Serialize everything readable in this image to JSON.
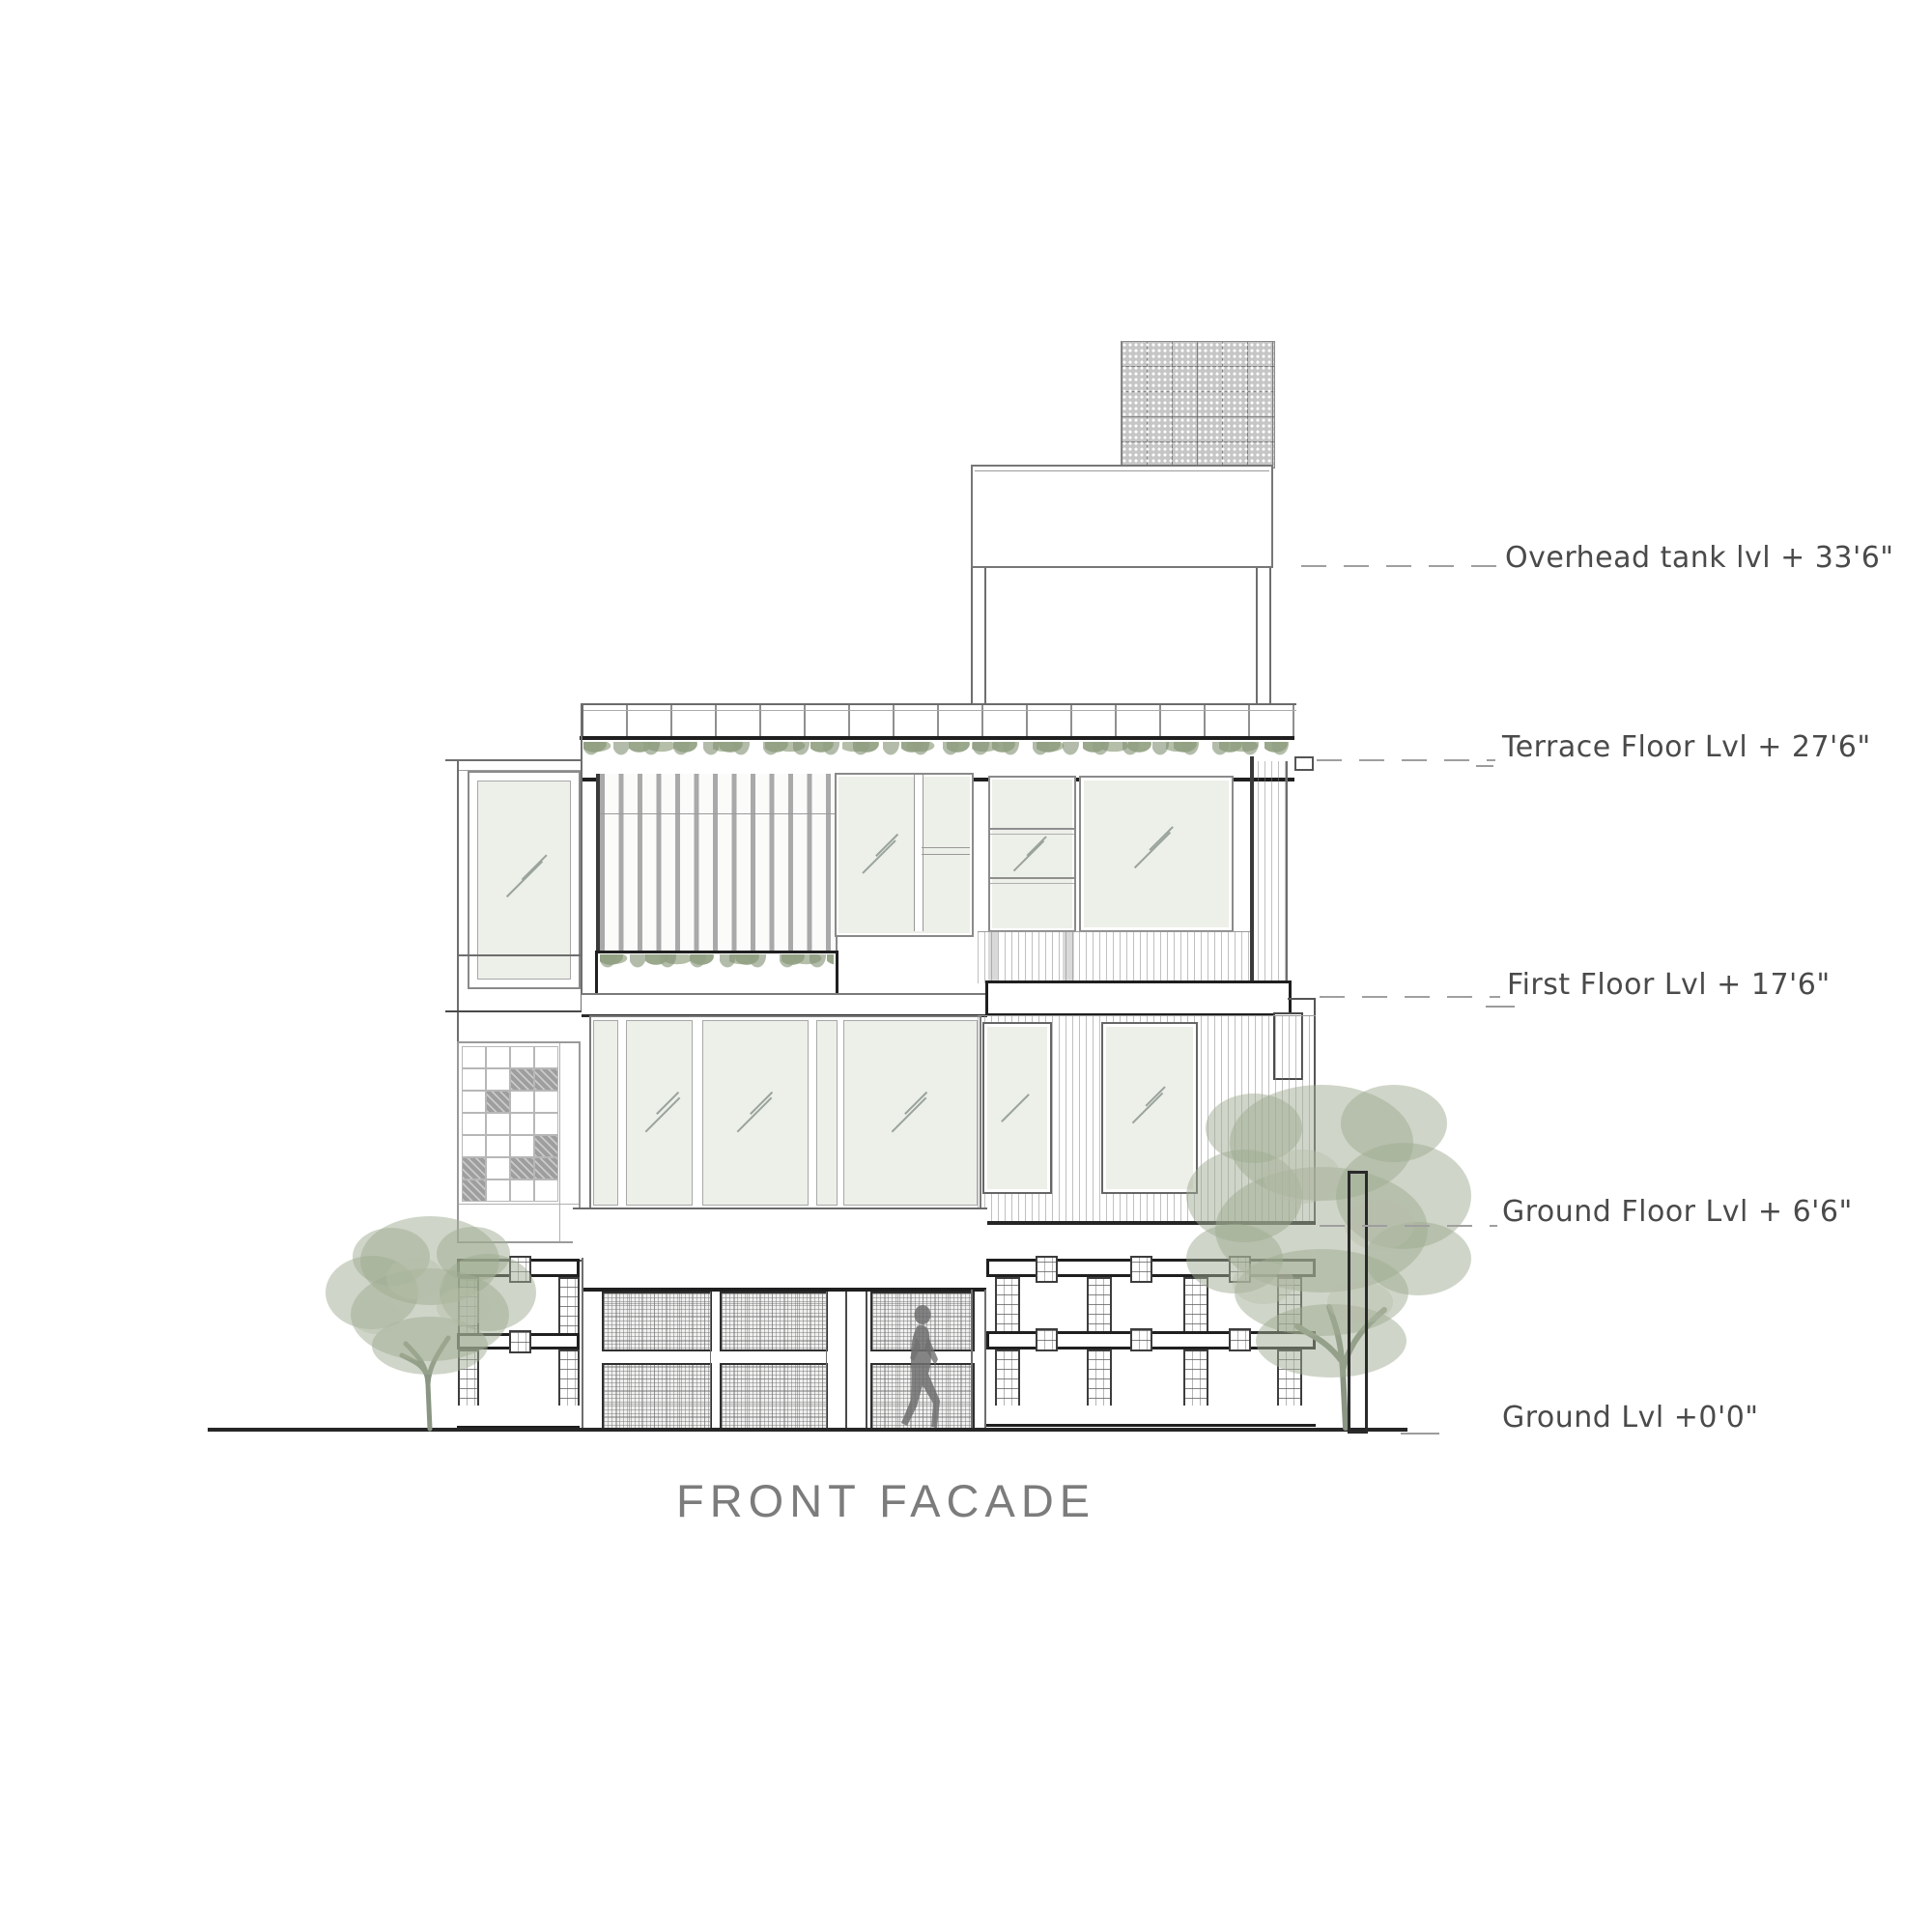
{
  "drawing": {
    "title": "FRONT FACADE"
  },
  "levels": [
    {
      "name": "overhead-tank-level",
      "label": "Overhead tank lvl + 33'6\""
    },
    {
      "name": "terrace-floor-level",
      "label": "Terrace Floor Lvl + 27'6\""
    },
    {
      "name": "first-floor-level",
      "label": "First Floor Lvl + 17'6\""
    },
    {
      "name": "ground-floor-level",
      "label": "Ground Floor Lvl  + 6'6\""
    },
    {
      "name": "ground-level",
      "label": "Ground Lvl +0'0\""
    }
  ],
  "colors": {
    "foliage": "#9fab92",
    "line": "#6e6e6e",
    "line_dark": "#262626",
    "glass": "#edefe9",
    "shaded_tile": "#9e9e9e",
    "label_text": "#4a4a4a",
    "title_text": "#7c7c7c"
  }
}
